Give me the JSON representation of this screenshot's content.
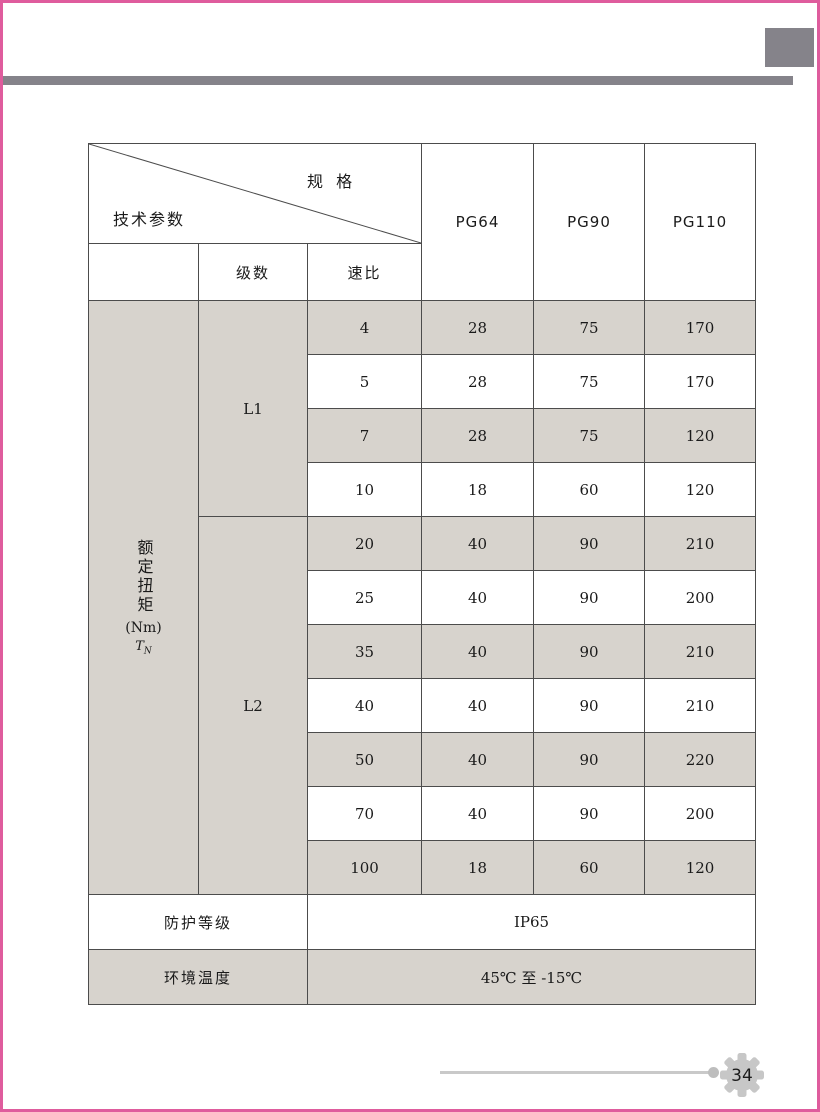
{
  "colors": {
    "border_pink": "#df5c9d",
    "accent_gray": "#85838a",
    "cell_shade": "#d7d3cd",
    "table_line": "#4c4c4c"
  },
  "header": {
    "corner_top": "规 格",
    "corner_bottom": "技术参数",
    "spec_columns": [
      "PG64",
      "PG90",
      "PG110"
    ],
    "stage_header": "级数",
    "ratio_header": "速比"
  },
  "torque": {
    "vertical_label": "额定扭矩",
    "unit": "(Nm)",
    "symbol": "T",
    "symbol_sub": "N"
  },
  "stages": [
    {
      "label": "L1"
    },
    {
      "label": "L2"
    }
  ],
  "rows": [
    {
      "ratio": "4",
      "pg64": "28",
      "pg90": "75",
      "pg110": "170"
    },
    {
      "ratio": "5",
      "pg64": "28",
      "pg90": "75",
      "pg110": "170"
    },
    {
      "ratio": "7",
      "pg64": "28",
      "pg90": "75",
      "pg110": "120"
    },
    {
      "ratio": "10",
      "pg64": "18",
      "pg90": "60",
      "pg110": "120"
    },
    {
      "ratio": "20",
      "pg64": "40",
      "pg90": "90",
      "pg110": "210"
    },
    {
      "ratio": "25",
      "pg64": "40",
      "pg90": "90",
      "pg110": "200"
    },
    {
      "ratio": "35",
      "pg64": "40",
      "pg90": "90",
      "pg110": "210"
    },
    {
      "ratio": "40",
      "pg64": "40",
      "pg90": "90",
      "pg110": "210"
    },
    {
      "ratio": "50",
      "pg64": "40",
      "pg90": "90",
      "pg110": "220"
    },
    {
      "ratio": "70",
      "pg64": "40",
      "pg90": "90",
      "pg110": "200"
    },
    {
      "ratio": "100",
      "pg64": "18",
      "pg90": "60",
      "pg110": "120"
    }
  ],
  "footer_rows": [
    {
      "label": "防护等级",
      "value": "IP65"
    },
    {
      "label": "环境温度",
      "value": "45℃ 至 -15℃"
    }
  ],
  "page_footer": {
    "page_number": "34"
  }
}
